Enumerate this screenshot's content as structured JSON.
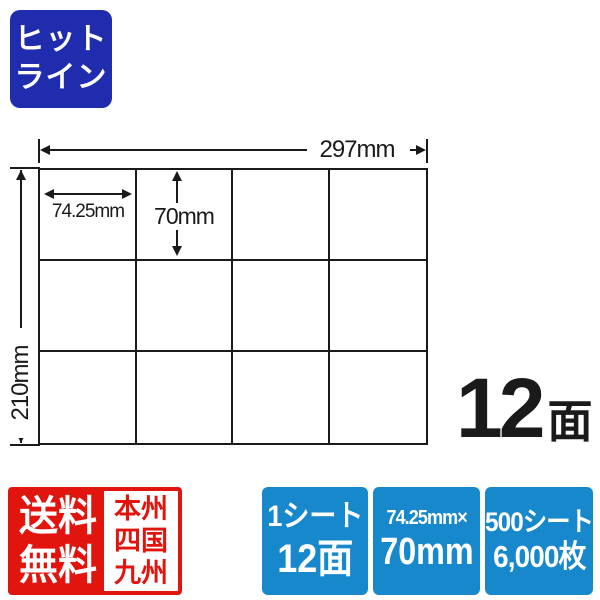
{
  "colors": {
    "logo-blue": "#1f2cae",
    "badge-blue": "#1688cb",
    "badge-red": "#e2140e",
    "ink": "#1a1a1a"
  },
  "logo": {
    "line1": "ヒット",
    "line2": "ライン"
  },
  "diagram": {
    "columns": 4,
    "rows": 3,
    "sheet_width_label": "297mm",
    "sheet_height_label": "210mm",
    "label_width": "74.25mm",
    "label_height": "70mm"
  },
  "face_count": {
    "number": "12",
    "unit": "面"
  },
  "footer_badges": {
    "shipping": {
      "line1": "送料",
      "line2": "無料",
      "regions": [
        "本州",
        "四国",
        "九州"
      ]
    },
    "specs": [
      {
        "line1": "1シート",
        "line2": "12面"
      },
      {
        "line1": "74.25mm×",
        "line2": "70mm"
      },
      {
        "line1": "500シート",
        "line2": "6,000枚"
      }
    ]
  }
}
